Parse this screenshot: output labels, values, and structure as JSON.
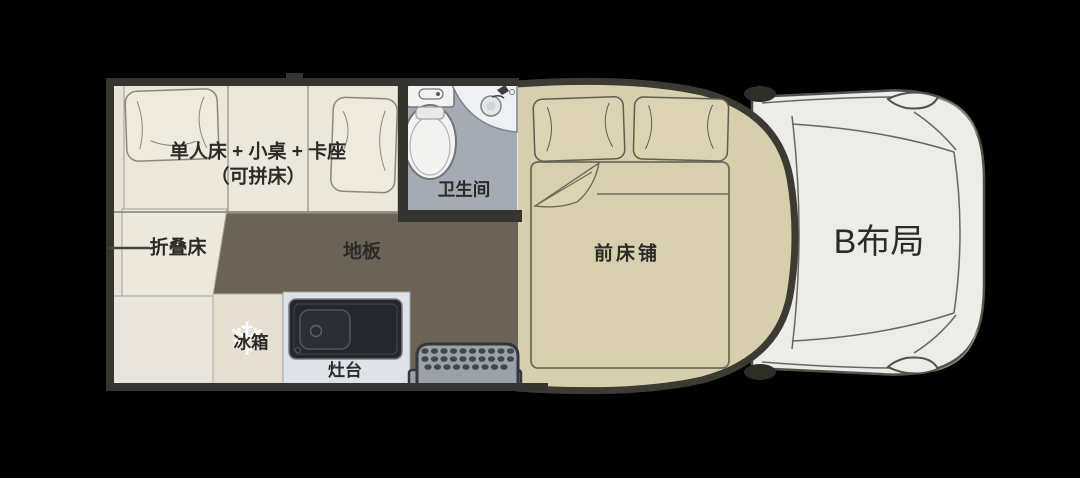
{
  "labels": {
    "combo_bed_line1": "单人床 + 小桌 + 卡座",
    "combo_bed_line2": "（可拼床）",
    "folding_bed": "折叠床",
    "floor": "地板",
    "bathroom": "卫生间",
    "fridge": "冰箱",
    "stove": "灶台",
    "front_bed": "前床铺",
    "layout": "B布局"
  },
  "icons": {
    "fridge_snowflake": "❄"
  },
  "colors": {
    "background": "#000000",
    "wall_dark": "#35342f",
    "panel_beige": "#eae5d8",
    "bed_panel_beige": "#ece7db",
    "floor_brown": "#6b6356",
    "bathroom_gray": "#a4abb4",
    "overcab_tan": "#d6cead",
    "bed_tan": "#d7cfae",
    "cab_body": "#ecede8",
    "counter_blue": "#dde3e9",
    "stove_dark": "#24272b",
    "step_gray": "#9ba1a9",
    "fridge_beige": "#e6dfd1",
    "text": "#2c2b27",
    "snowflake": "#ffffff"
  }
}
